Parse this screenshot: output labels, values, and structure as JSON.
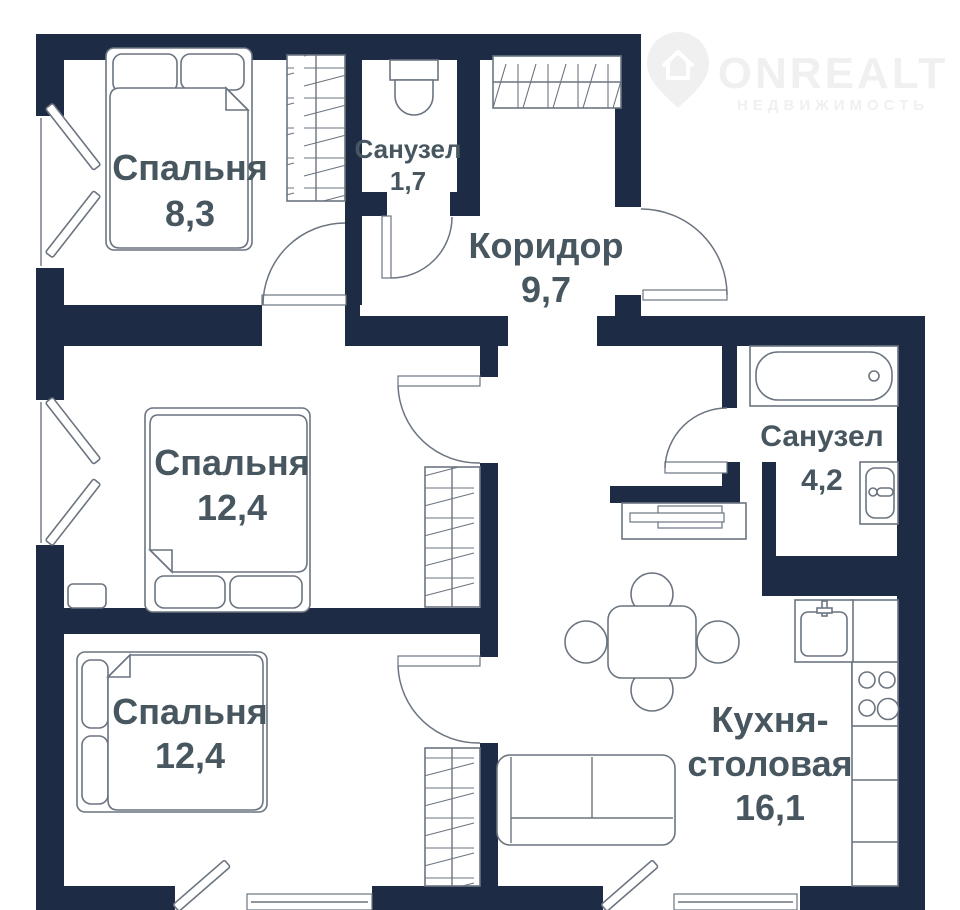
{
  "logo": {
    "brand": "ONREALT",
    "tagline": "НЕДВИЖИМОСТЬ"
  },
  "rooms": {
    "bedroom_top": {
      "label": "Спальня",
      "area": "8,3"
    },
    "bathroom_small": {
      "label": "Санузел",
      "area": "1,7"
    },
    "corridor": {
      "label": "Коридор",
      "area": "9,7"
    },
    "bedroom_middle": {
      "label": "Спальня",
      "area": "12,4"
    },
    "bathroom_main": {
      "label": "Санузел",
      "area": "4,2"
    },
    "bedroom_bottom": {
      "label": "Спальня",
      "area": "12,4"
    },
    "kitchen": {
      "label_line1": "Кухня-",
      "label_line2": "столовая",
      "area": "16,1"
    }
  },
  "colors": {
    "wall": "#1e2b44",
    "room_label": "#47565f",
    "furniture_line": "#6b7480",
    "logo": "#f0f0f1",
    "background": "#ffffff"
  }
}
